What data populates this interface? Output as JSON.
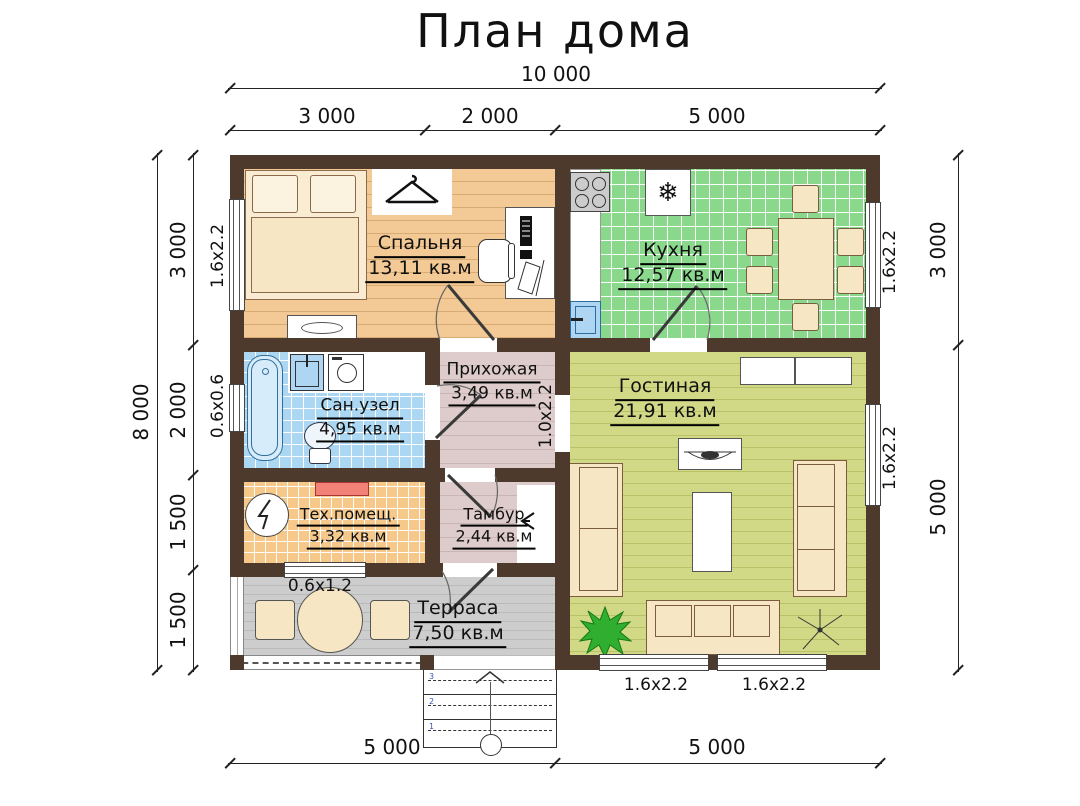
{
  "title": "План дома",
  "rooms": {
    "bedroom": {
      "name": "Спальня",
      "area": "13,11 кв.м"
    },
    "kitchen": {
      "name": "Кухня",
      "area": "12,57 кв.м"
    },
    "bathroom": {
      "name": "Сан.узел",
      "area": "4,95 кв.м"
    },
    "hallway": {
      "name": "Прихожая",
      "area": "3,49 кв.м"
    },
    "living": {
      "name": "Гостиная",
      "area": "21,91 кв.м"
    },
    "utility": {
      "name": "Тех.помещ.",
      "area": "3,32 кв.м"
    },
    "vestibule": {
      "name": "Тамбур",
      "area": "2,44 кв.м"
    },
    "terrace": {
      "name": "Терраса",
      "area": "7,50 кв.м"
    }
  },
  "dimensions": {
    "top_total": "10 000",
    "top_segments": [
      "3 000",
      "2 000",
      "5 000"
    ],
    "left_total": "8 000",
    "left_segments": [
      "3 000",
      "2 000",
      "1 500",
      "1 500"
    ],
    "right_segments": [
      "3 000",
      "5 000"
    ],
    "bottom_segments": [
      "5 000",
      "5 000"
    ]
  },
  "openings": {
    "bedroom_window": "1.6х2.2",
    "bathroom_window": "0.6х0.6",
    "kitchen_window": "1.6х2.2",
    "living_window_right": "1.6х2.2",
    "living_window_bottom_left": "1.6х2.2",
    "living_window_bottom_right": "1.6х2.2",
    "utility_window": "0.6х1.2",
    "hallway_living_door": "1.0х2.2"
  },
  "stairs": {
    "step_numbers": [
      "3",
      "2",
      "1"
    ]
  },
  "icons": {
    "snowflake_icon": "❄"
  },
  "colors": {
    "wall": "#4e392d",
    "bedroom_floor": "#f3ca96",
    "kitchen_floor": "#8ad88c",
    "living_floor": "#d1d987",
    "bathroom_floor": "#abd7f2",
    "hallway_floor": "#ddcccb",
    "utility_floor": "#f6c98b",
    "terrace_floor": "#cdcdcd",
    "furniture": "#f6e6c4",
    "heater_red": "#f28277",
    "plant_green": "#2fae2f",
    "sink_blue": "#aed6f2"
  }
}
